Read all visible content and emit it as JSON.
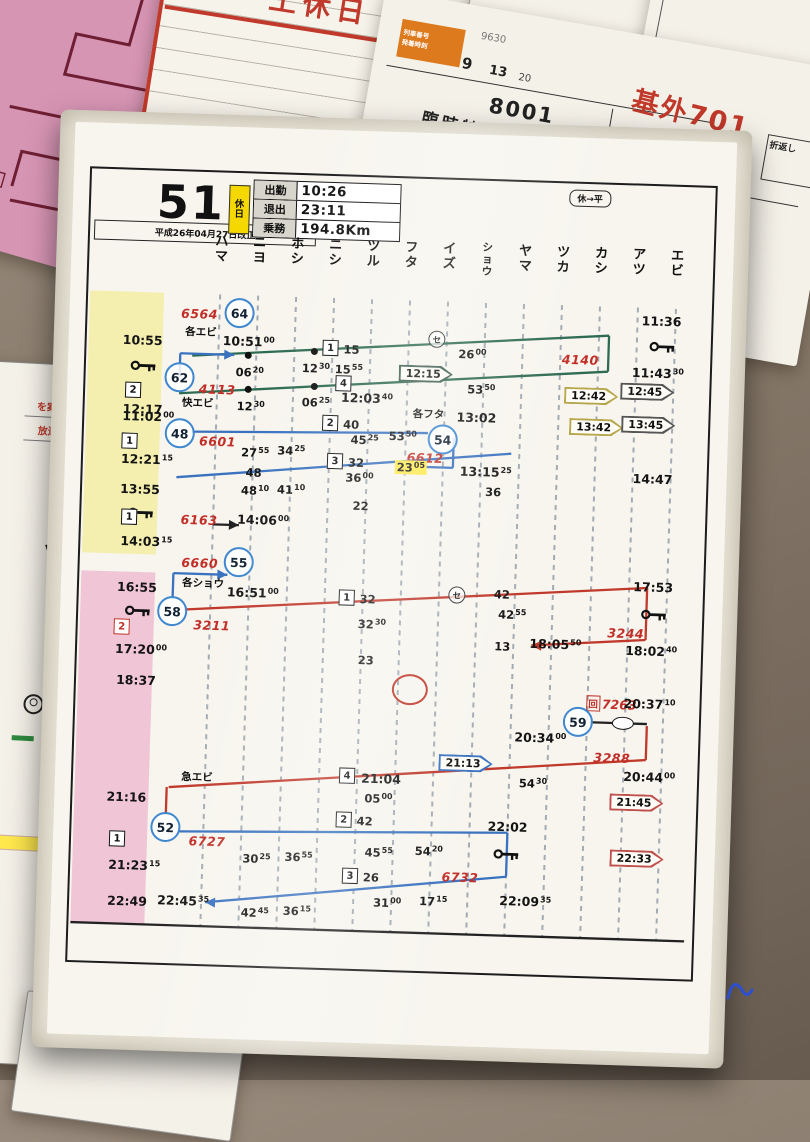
{
  "bg_cards": {
    "dojitsu": {
      "title": "土休日",
      "number": "No. 1"
    },
    "sliver_text1": "2 0 1",
    "sliver_text2": "10000",
    "rinji": {
      "head_label1": "列車番号",
      "head_label2": "発着時刻",
      "small_no": "9630",
      "col_a": "9",
      "col_b": "13",
      "col_c": "20",
      "train_no": "8001",
      "train_type": "臨時特急",
      "title": "基外701",
      "note": "折返し",
      "new_label": "新",
      "circled2": "②",
      "dep_time": "09  25"
    },
    "left_card": {
      "red1": "を案内",
      "red2": "放送」",
      "kana1": "ア",
      "kana2": "ツ"
    }
  },
  "main_card": {
    "header": {
      "duty_number": "51",
      "revision": "平成26年04月27日改正",
      "holiday_badge": "休日",
      "pill": "休→平",
      "table": [
        {
          "label": "出勤",
          "value": "10:26"
        },
        {
          "label": "退出",
          "value": "23:11"
        },
        {
          "label": "乗務",
          "value": "194.8Km"
        }
      ]
    },
    "stations": [
      "ハマ",
      "ニヨ",
      "ホシ",
      "ニシ",
      "ツル",
      "フタ",
      "イズ",
      "ショウ",
      "ヤマ",
      "ツカ",
      "カシ",
      "アツ",
      "エビ"
    ],
    "diagram": {
      "colors": {
        "green": "#2e6b52",
        "blue": "#3a72c0",
        "red": "#c0392b",
        "black": "#222222"
      },
      "lines": [
        {
          "x1": 124,
          "y1": 230,
          "x2": 540,
          "y2": 197,
          "c": "green"
        },
        {
          "x1": 540,
          "y1": 197,
          "x2": 540,
          "y2": 233,
          "c": "green"
        },
        {
          "x1": 540,
          "y1": 233,
          "x2": 112,
          "y2": 268,
          "c": "green"
        },
        {
          "x1": 112,
          "y1": 252,
          "x2": 112,
          "y2": 228,
          "c": "blue"
        },
        {
          "x1": 112,
          "y1": 228,
          "x2": 166,
          "y2": 228,
          "c": "blue",
          "a": "r"
        },
        {
          "x1": 126,
          "y1": 306,
          "x2": 362,
          "y2": 300,
          "c": "blue"
        },
        {
          "x1": 388,
          "y1": 304,
          "x2": 388,
          "y2": 334,
          "c": "blue"
        },
        {
          "x1": 388,
          "y1": 334,
          "x2": 334,
          "y2": 334,
          "c": "blue"
        },
        {
          "x1": 112,
          "y1": 352,
          "x2": 446,
          "y2": 318,
          "c": "blue"
        },
        {
          "x1": 112,
          "y1": 472,
          "x2": 112,
          "y2": 448,
          "c": "blue"
        },
        {
          "x1": 112,
          "y1": 448,
          "x2": 166,
          "y2": 448,
          "c": "blue",
          "a": "r"
        },
        {
          "x1": 124,
          "y1": 484,
          "x2": 586,
          "y2": 448,
          "c": "red"
        },
        {
          "x1": 586,
          "y1": 448,
          "x2": 586,
          "y2": 500,
          "c": "red"
        },
        {
          "x1": 586,
          "y1": 500,
          "x2": 472,
          "y2": 509,
          "c": "red",
          "a": "l"
        },
        {
          "x1": 533,
          "y1": 584,
          "x2": 590,
          "y2": 584,
          "c": "black"
        },
        {
          "x1": 590,
          "y1": 586,
          "x2": 590,
          "y2": 620,
          "c": "red"
        },
        {
          "x1": 590,
          "y1": 620,
          "x2": 114,
          "y2": 662,
          "c": "red"
        },
        {
          "x1": 112,
          "y1": 662,
          "x2": 112,
          "y2": 690,
          "c": "red"
        },
        {
          "x1": 124,
          "y1": 706,
          "x2": 454,
          "y2": 697,
          "c": "blue"
        },
        {
          "x1": 454,
          "y1": 697,
          "x2": 454,
          "y2": 741,
          "c": "blue"
        },
        {
          "x1": 454,
          "y1": 741,
          "x2": 154,
          "y2": 776,
          "c": "blue",
          "a": "l"
        },
        {
          "x1": 150,
          "y1": 398,
          "x2": 176,
          "y2": 398,
          "c": "black",
          "a": "r"
        },
        {
          "x1": 20,
          "y1": 800,
          "x2": 634,
          "y2": 800,
          "c": "black"
        }
      ],
      "els": [
        {
          "k": "red",
          "t": "6564",
          "x": 130,
          "y": 188,
          "n": "train-number-6564"
        },
        {
          "k": "circ",
          "t": "64",
          "x": 170,
          "y": 186,
          "n": "trainset-circle-64"
        },
        {
          "k": "jp",
          "t": "各エビ",
          "x": 132,
          "y": 206,
          "n": "train-type-kaku-ebi"
        },
        {
          "k": "tms",
          "t": "10:51",
          "s": "00",
          "x": 180,
          "y": 214
        },
        {
          "k": "tm",
          "t": "10:55",
          "x": 74,
          "y": 216
        },
        {
          "k": "key",
          "x": 76,
          "y": 242
        },
        {
          "k": "box",
          "t": "2",
          "x": 66,
          "y": 266
        },
        {
          "k": "tms",
          "t": "11:02",
          "s": "00",
          "x": 82,
          "y": 292
        },
        {
          "k": "circ",
          "t": "62",
          "x": 112,
          "y": 252,
          "n": "trainset-circle-62"
        },
        {
          "k": "red",
          "t": "4113",
          "x": 150,
          "y": 263,
          "n": "train-number-4113"
        },
        {
          "k": "dot",
          "x": 180,
          "y": 228
        },
        {
          "k": "sms",
          "t": "06",
          "s": "20",
          "x": 182,
          "y": 245
        },
        {
          "k": "dot",
          "x": 246,
          "y": 222
        },
        {
          "k": "sms",
          "t": "12",
          "s": "30",
          "x": 248,
          "y": 239
        },
        {
          "k": "box",
          "t": "1",
          "x": 262,
          "y": 218
        },
        {
          "k": "sm",
          "t": "15",
          "x": 283,
          "y": 219
        },
        {
          "k": "sms",
          "t": "15",
          "s": "55",
          "x": 281,
          "y": 239
        },
        {
          "k": "scirc",
          "t": "セ",
          "x": 368,
          "y": 206
        },
        {
          "k": "sms",
          "t": "26",
          "s": "00",
          "x": 404,
          "y": 220
        },
        {
          "k": "red",
          "t": "4140",
          "x": 512,
          "y": 222,
          "n": "train-number-4140"
        },
        {
          "k": "tm",
          "t": "11:36",
          "x": 592,
          "y": 181
        },
        {
          "k": "key",
          "x": 594,
          "y": 207
        },
        {
          "k": "tms",
          "t": "11:43",
          "s": "30",
          "x": 590,
          "y": 233
        },
        {
          "k": "badge",
          "t": "12:15",
          "x": 358,
          "y": 241,
          "o": "#3d5c50"
        },
        {
          "k": "sms",
          "t": "53",
          "s": "50",
          "x": 414,
          "y": 255
        },
        {
          "k": "badge",
          "t": "12:42",
          "x": 524,
          "y": 258,
          "o": "#b7a64b"
        },
        {
          "k": "badge",
          "t": "12:45",
          "x": 580,
          "y": 252,
          "o": "#555555"
        },
        {
          "k": "tm",
          "t": "12:17",
          "x": 76,
          "y": 285
        },
        {
          "k": "jp",
          "t": "快エビ",
          "x": 131,
          "y": 277,
          "n": "train-type-kai-ebi"
        },
        {
          "k": "dot",
          "x": 181,
          "y": 262
        },
        {
          "k": "sms",
          "t": "12",
          "s": "30",
          "x": 184,
          "y": 279
        },
        {
          "k": "dot",
          "x": 247,
          "y": 257
        },
        {
          "k": "box",
          "t": "4",
          "x": 276,
          "y": 253
        },
        {
          "k": "sms",
          "t": "06",
          "s": "25",
          "x": 249,
          "y": 273
        },
        {
          "k": "tms",
          "t": "12:03",
          "s": "40",
          "x": 300,
          "y": 267
        },
        {
          "k": "jp",
          "t": "各フタ",
          "x": 362,
          "y": 281,
          "n": "train-type-kaku-futa"
        },
        {
          "k": "tm",
          "t": "13:02",
          "x": 410,
          "y": 283
        },
        {
          "k": "badge",
          "t": "13:42",
          "x": 530,
          "y": 289,
          "o": "#b7a64b"
        },
        {
          "k": "badge",
          "t": "13:45",
          "x": 582,
          "y": 285,
          "o": "#555555"
        },
        {
          "k": "circ",
          "t": "48",
          "x": 114,
          "y": 308,
          "n": "trainset-circle-48"
        },
        {
          "k": "red",
          "t": "6601",
          "x": 152,
          "y": 315,
          "n": "train-number-6601"
        },
        {
          "k": "box",
          "t": "1",
          "x": 64,
          "y": 317
        },
        {
          "k": "tms",
          "t": "12:21",
          "s": "15",
          "x": 82,
          "y": 335
        },
        {
          "k": "sms",
          "t": "27",
          "s": "55",
          "x": 190,
          "y": 325
        },
        {
          "k": "sms",
          "t": "34",
          "s": "25",
          "x": 226,
          "y": 322
        },
        {
          "k": "box",
          "t": "2",
          "x": 264,
          "y": 293
        },
        {
          "k": "sm",
          "t": "40",
          "x": 285,
          "y": 294
        },
        {
          "k": "sms",
          "t": "45",
          "s": "25",
          "x": 299,
          "y": 309
        },
        {
          "k": "sms",
          "t": "53",
          "s": "50",
          "x": 337,
          "y": 304
        },
        {
          "k": "circ",
          "t": "54",
          "x": 377,
          "y": 306,
          "n": "trainset-circle-54"
        },
        {
          "k": "red",
          "t": "6612",
          "x": 360,
          "y": 325,
          "n": "train-number-6612"
        },
        {
          "k": "hl",
          "t": "23",
          "s": "05",
          "x": 346,
          "y": 335,
          "n": "highlighted-time-2305"
        },
        {
          "k": "tms",
          "t": "13:15",
          "s": "25",
          "x": 421,
          "y": 337
        },
        {
          "k": "sm",
          "t": "36",
          "x": 429,
          "y": 357
        },
        {
          "k": "tm",
          "t": "13:55",
          "x": 76,
          "y": 365
        },
        {
          "k": "key",
          "x": 78,
          "y": 389
        },
        {
          "k": "sm",
          "t": "48",
          "x": 189,
          "y": 345
        },
        {
          "k": "sms",
          "t": "48",
          "s": "10",
          "x": 191,
          "y": 363
        },
        {
          "k": "sms",
          "t": "41",
          "s": "10",
          "x": 227,
          "y": 361
        },
        {
          "k": "box",
          "t": "3",
          "x": 270,
          "y": 331
        },
        {
          "k": "sm",
          "t": "32",
          "x": 291,
          "y": 332
        },
        {
          "k": "sms",
          "t": "36",
          "s": "00",
          "x": 295,
          "y": 347
        },
        {
          "k": "sm",
          "t": "22",
          "x": 297,
          "y": 375
        },
        {
          "k": "tm",
          "t": "14:47",
          "x": 588,
          "y": 339
        },
        {
          "k": "box",
          "t": "1",
          "x": 66,
          "y": 393
        },
        {
          "k": "tms",
          "t": "14:03",
          "s": "15",
          "x": 84,
          "y": 417
        },
        {
          "k": "red",
          "t": "6163",
          "x": 136,
          "y": 394,
          "n": "train-number-6163"
        },
        {
          "k": "tms",
          "t": "14:06",
          "s": "00",
          "x": 200,
          "y": 392
        },
        {
          "k": "red",
          "t": "6660",
          "x": 138,
          "y": 437,
          "n": "train-number-6660"
        },
        {
          "k": "circ",
          "t": "55",
          "x": 177,
          "y": 435,
          "n": "trainset-circle-55"
        },
        {
          "k": "jp",
          "t": "各ショウ",
          "x": 142,
          "y": 457,
          "n": "train-type-kaku-sho"
        },
        {
          "k": "tms",
          "t": "16:51",
          "s": "00",
          "x": 192,
          "y": 465
        },
        {
          "k": "tm",
          "t": "16:55",
          "x": 76,
          "y": 463
        },
        {
          "k": "key",
          "x": 78,
          "y": 487
        },
        {
          "k": "circ",
          "t": "58",
          "x": 112,
          "y": 486,
          "n": "trainset-circle-58"
        },
        {
          "k": "red",
          "t": "3211",
          "x": 152,
          "y": 499,
          "n": "train-number-3211"
        },
        {
          "k": "rbox",
          "t": "2",
          "x": 62,
          "y": 503
        },
        {
          "k": "tms",
          "t": "17:20",
          "s": "00",
          "x": 82,
          "y": 525
        },
        {
          "k": "tm",
          "t": "18:37",
          "x": 78,
          "y": 556
        },
        {
          "k": "box",
          "t": "1",
          "x": 286,
          "y": 467
        },
        {
          "k": "sm",
          "t": "32",
          "x": 307,
          "y": 468
        },
        {
          "k": "sms",
          "t": "32",
          "s": "30",
          "x": 312,
          "y": 493
        },
        {
          "k": "sm",
          "t": "23",
          "x": 307,
          "y": 529
        },
        {
          "k": "scirc",
          "t": "セ",
          "x": 396,
          "y": 461
        },
        {
          "k": "sm",
          "t": "42",
          "x": 441,
          "y": 459
        },
        {
          "k": "sms",
          "t": "42",
          "s": "55",
          "x": 452,
          "y": 479
        },
        {
          "k": "sm",
          "t": "13",
          "x": 443,
          "y": 511
        },
        {
          "k": "tms",
          "t": "18:05",
          "s": "50",
          "x": 496,
          "y": 507
        },
        {
          "k": "red",
          "t": "3244",
          "x": 566,
          "y": 494,
          "n": "train-number-3244"
        },
        {
          "k": "tm",
          "t": "17:53",
          "x": 592,
          "y": 447
        },
        {
          "k": "key",
          "x": 594,
          "y": 475
        },
        {
          "k": "tms",
          "t": "18:02",
          "s": "40",
          "x": 592,
          "y": 511
        },
        {
          "k": "redO",
          "x": 352,
          "y": 557,
          "n": "red-circle-mark"
        },
        {
          "k": "kai",
          "t": "7263",
          "x": 554,
          "y": 565,
          "n": "deadhead-train-7263"
        },
        {
          "k": "circ",
          "t": "59",
          "x": 521,
          "y": 584,
          "n": "trainset-circle-59"
        },
        {
          "k": "oval",
          "x": 566,
          "y": 584
        },
        {
          "k": "tms",
          "t": "20:37",
          "s": "10",
          "x": 592,
          "y": 564
        },
        {
          "k": "tms",
          "t": "20:34",
          "s": "00",
          "x": 484,
          "y": 601
        },
        {
          "k": "red",
          "t": "3288",
          "x": 556,
          "y": 619,
          "n": "train-number-3288"
        },
        {
          "k": "badge",
          "t": "21:13",
          "x": 410,
          "y": 629,
          "o": "#3a72c0"
        },
        {
          "k": "sms",
          "t": "54",
          "s": "30",
          "x": 478,
          "y": 647
        },
        {
          "k": "tms",
          "t": "20:44",
          "s": "00",
          "x": 594,
          "y": 637
        },
        {
          "k": "badge",
          "t": "21:45",
          "x": 582,
          "y": 663,
          "o": "#c0504d"
        },
        {
          "k": "badge",
          "t": "22:33",
          "x": 584,
          "y": 719,
          "o": "#c0504d"
        },
        {
          "k": "jp",
          "t": "急エビ",
          "x": 142,
          "y": 651,
          "n": "train-type-kyu-ebi"
        },
        {
          "k": "tm",
          "t": "21:16",
          "x": 72,
          "y": 673
        },
        {
          "k": "box",
          "t": "4",
          "x": 292,
          "y": 645
        },
        {
          "k": "tm",
          "t": "21:04",
          "x": 326,
          "y": 647
        },
        {
          "k": "sms",
          "t": "05",
          "s": "00",
          "x": 324,
          "y": 667
        },
        {
          "k": "circ",
          "t": "52",
          "x": 112,
          "y": 702,
          "n": "trainset-circle-52"
        },
        {
          "k": "red",
          "t": "6727",
          "x": 154,
          "y": 715,
          "n": "train-number-6727"
        },
        {
          "k": "box",
          "t": "1",
          "x": 64,
          "y": 715
        },
        {
          "k": "tms",
          "t": "21:23",
          "s": "15",
          "x": 82,
          "y": 741
        },
        {
          "k": "sms",
          "t": "30",
          "s": "25",
          "x": 204,
          "y": 731
        },
        {
          "k": "sms",
          "t": "36",
          "s": "55",
          "x": 246,
          "y": 728
        },
        {
          "k": "box",
          "t": "2",
          "x": 290,
          "y": 689
        },
        {
          "k": "sm",
          "t": "42",
          "x": 311,
          "y": 690
        },
        {
          "k": "sms",
          "t": "45",
          "s": "55",
          "x": 326,
          "y": 721
        },
        {
          "k": "sms",
          "t": "54",
          "s": "20",
          "x": 376,
          "y": 718
        },
        {
          "k": "tm",
          "t": "22:02",
          "x": 454,
          "y": 691
        },
        {
          "k": "key",
          "x": 454,
          "y": 719
        },
        {
          "k": "box",
          "t": "3",
          "x": 298,
          "y": 745
        },
        {
          "k": "sm",
          "t": "26",
          "x": 319,
          "y": 746
        },
        {
          "k": "red",
          "t": "6732",
          "x": 408,
          "y": 743,
          "n": "train-number-6732"
        },
        {
          "k": "sms",
          "t": "31",
          "s": "00",
          "x": 336,
          "y": 771
        },
        {
          "k": "sms",
          "t": "17",
          "s": "15",
          "x": 382,
          "y": 768
        },
        {
          "k": "tms",
          "t": "22:09",
          "s": "35",
          "x": 474,
          "y": 765
        },
        {
          "k": "tm",
          "t": "22:49",
          "x": 76,
          "y": 777
        },
        {
          "k": "tms",
          "t": "22:45",
          "s": "35",
          "x": 132,
          "y": 775
        },
        {
          "k": "sms",
          "t": "42",
          "s": "45",
          "x": 204,
          "y": 785
        },
        {
          "k": "sms",
          "t": "36",
          "s": "15",
          "x": 246,
          "y": 782
        }
      ]
    }
  }
}
